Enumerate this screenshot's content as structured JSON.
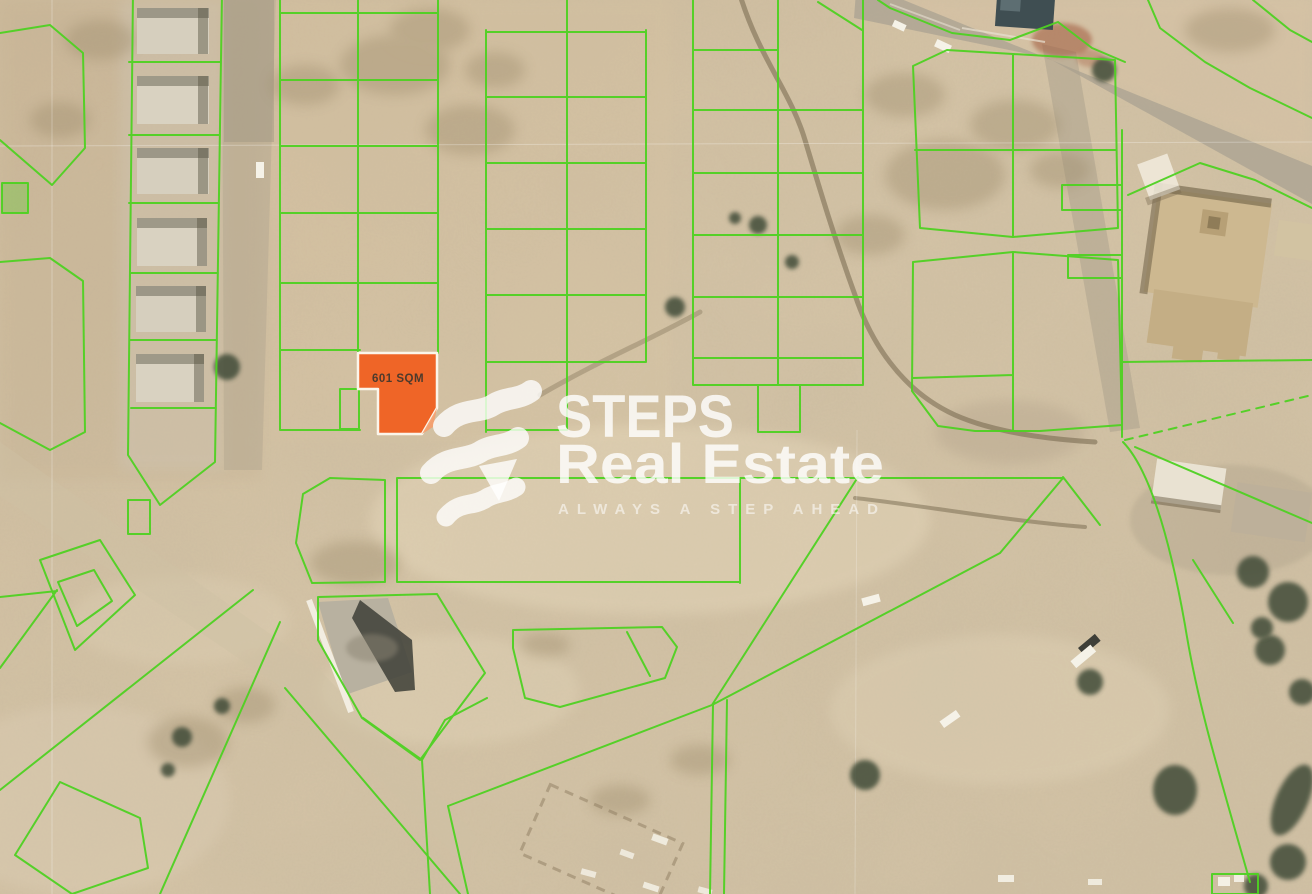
{
  "map": {
    "highlighted_plot": {
      "area_label": "601 SQM",
      "fill_color": "#ef6527",
      "border_color": "#fbf5ea",
      "label_color": "#4c3a2c"
    },
    "boundaries": {
      "line_color": "#4ed122"
    },
    "watermark": {
      "brand_line1": "STEPS",
      "brand_line2": "Real Estate",
      "tagline": "ALWAYS A STEP AHEAD",
      "text_color": "#ffffff"
    }
  }
}
